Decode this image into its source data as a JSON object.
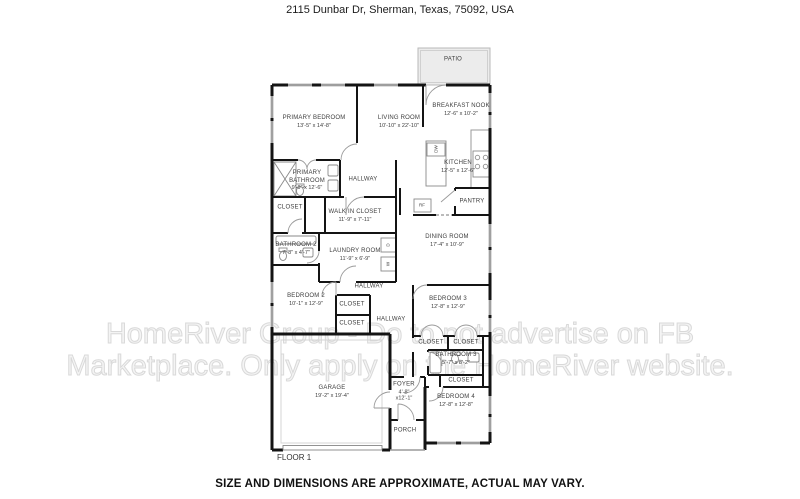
{
  "header": {
    "address": "2115 Dunbar Dr, Sherman, Texas, 75092, USA"
  },
  "footer": {
    "floor_label": "FLOOR 1",
    "disclaimer": "SIZE AND DIMENSIONS ARE APPROXIMATE, ACTUAL MAY VARY."
  },
  "watermark": {
    "line1": "HomeRiver Group - Do to not advertise on FB",
    "line2": "Marketplace. Only apply on the HomeRiver website."
  },
  "colors": {
    "wall": "#141414",
    "patio_fill": "#ececec",
    "watermark": "#d9d9d9",
    "label_text": "#3d3d3d"
  },
  "rooms": [
    {
      "name": "PATIO",
      "dims": ""
    },
    {
      "name": "PRIMARY BEDROOM",
      "dims": "13'-5\" x 14'-8\""
    },
    {
      "name": "LIVING ROOM",
      "dims": "10'-10\" x 22'-10\""
    },
    {
      "name": "BREAKFAST NOOK",
      "dims": "12'-6\" x 10'-2\""
    },
    {
      "name": "KITCHEN",
      "dims": "12'-5\" x 12'-6\""
    },
    {
      "name": "PRIMARY BATHROOM",
      "dims": "9'-9\" x 12'-6\""
    },
    {
      "name": "HALLWAY",
      "dims": ""
    },
    {
      "name": "CLOSET",
      "dims": ""
    },
    {
      "name": "WALK IN CLOSET",
      "dims": "11'-9\" x 7'-11\""
    },
    {
      "name": "BATHROOM 2",
      "dims": "7'-8\" x 4'-7\""
    },
    {
      "name": "LAUNDRY ROOM",
      "dims": "11'-9\" x 6'-9\""
    },
    {
      "name": "PANTRY",
      "dims": ""
    },
    {
      "name": "DINING ROOM",
      "dims": "17'-4\" x 10'-9\""
    },
    {
      "name": "BEDROOM 2",
      "dims": "10'-1\" x 12'-9\""
    },
    {
      "name": "HALLWAY",
      "dims": ""
    },
    {
      "name": "CLOSET",
      "dims": ""
    },
    {
      "name": "CLOSET",
      "dims": ""
    },
    {
      "name": "HALLWAY",
      "dims": ""
    },
    {
      "name": "BEDROOM 3",
      "dims": "12'-8\" x 12'-9\""
    },
    {
      "name": "CLOSET",
      "dims": ""
    },
    {
      "name": "CLOSET",
      "dims": ""
    },
    {
      "name": "BATHROOM 3",
      "dims": "5'-7\" x 8'-2\""
    },
    {
      "name": "CLOSET",
      "dims": ""
    },
    {
      "name": "GARAGE",
      "dims": "19'-2\" x 19'-4\""
    },
    {
      "name": "FOYER",
      "dims": "4'-8\" x12'-1\""
    },
    {
      "name": "PORCH",
      "dims": ""
    },
    {
      "name": "BEDROOM 4",
      "dims": "12'-8\" x 12'-8\""
    }
  ],
  "appliances": {
    "dishwasher": "DW",
    "refrigerator": "RF",
    "washer": "W",
    "dryer": "D"
  }
}
